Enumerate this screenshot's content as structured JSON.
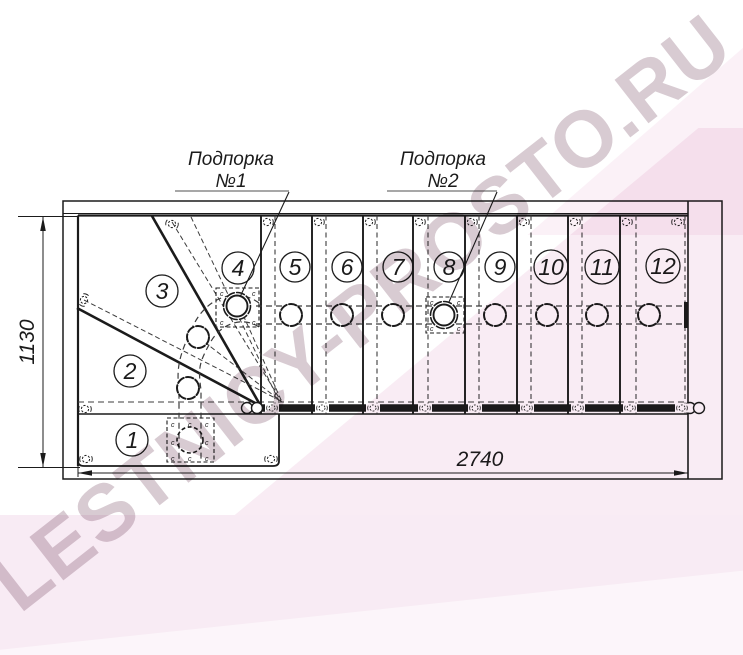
{
  "callouts": {
    "support1": {
      "label": "Подпорка",
      "number": "№1"
    },
    "support2": {
      "label": "Подпорка",
      "number": "№2"
    }
  },
  "dimensions": {
    "horizontal": "2740",
    "vertical": "1130"
  },
  "steps": [
    "1",
    "2",
    "3",
    "4",
    "5",
    "6",
    "7",
    "8",
    "9",
    "10",
    "11",
    "12"
  ],
  "connector_mark": "c",
  "watermark": {
    "text": "LESTNICY-PROSTO.RU"
  },
  "colors": {
    "line": "#1b1b1b",
    "hidden_line": "#3c3c3c",
    "pink_overlay": "#f9ecf4",
    "watermark_text": "#d8cbd2",
    "underline": "#8a8a8a"
  }
}
